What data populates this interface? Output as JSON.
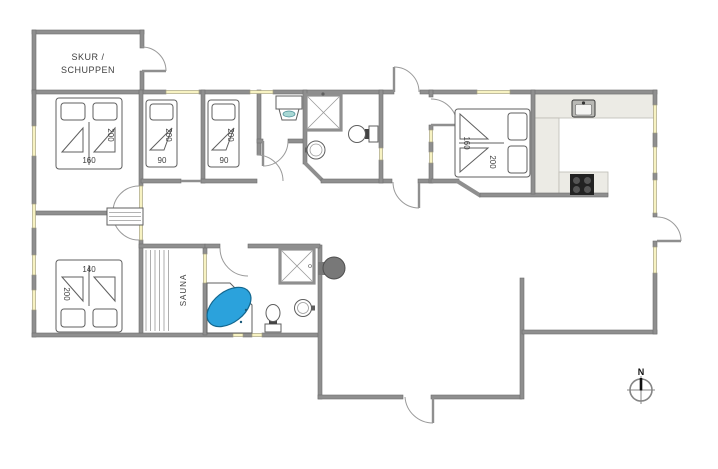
{
  "colors": {
    "wall": "#8f8f8f",
    "wall_edge": "#6e6e6e",
    "glass": "#f7f2c2",
    "glass_edge": "#aaa583",
    "arc": "#9a9a9a",
    "fixture": "#5f5f5f",
    "fixture_light": "#9a9a9a",
    "label": "#3f3f3f",
    "counter": "#ecebe5",
    "counter_edge": "#bdbcb4",
    "tub": "#2ba2dc",
    "tub_edge": "#13678f",
    "hob": "#222222",
    "burner": "#555555",
    "wood_stove": "#787878",
    "basin": "#a8d8d4"
  },
  "plan": {
    "shed_label_line1": "SKUR /",
    "shed_label_line2": "SCHUPPEN",
    "sauna_label": "SAUNA",
    "compass_north_label": "N",
    "beds": {
      "master_top_left": {
        "width_cm": "160",
        "length_cm": "200"
      },
      "single_left": {
        "width_cm": "90",
        "length_cm": "200"
      },
      "single_right": {
        "width_cm": "90",
        "length_cm": "200"
      },
      "double_bottom_left": {
        "width_cm": "140",
        "length_cm": "200"
      },
      "double_right": {
        "width_cm": "160",
        "length_cm": "200"
      }
    }
  }
}
